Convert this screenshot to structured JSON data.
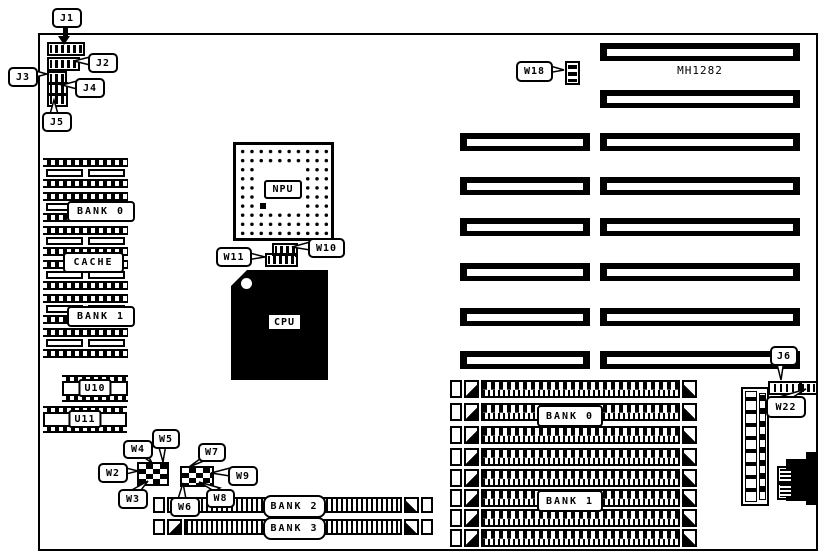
{
  "board": {
    "model": "MH1282"
  },
  "jumpers": {
    "j1": "J1",
    "j2": "J2",
    "j3": "J3",
    "j4": "J4",
    "j5": "J5",
    "j6": "J6",
    "w2": "W2",
    "w3": "W3",
    "w4": "W4",
    "w5": "W5",
    "w6": "W6",
    "w7": "W7",
    "w8": "W8",
    "w9": "W9",
    "w10": "W10",
    "w11": "W11",
    "w18": "W18",
    "w22": "W22"
  },
  "chips": {
    "npu": "NPU",
    "cpu": "CPU",
    "u10": "U10",
    "u11": "U11"
  },
  "memory": {
    "bank0_dip": "BANK 0",
    "cache": "CACHE",
    "bank1_dip": "BANK 1",
    "bank0_simm": "BANK 0",
    "bank1_simm": "BANK 1",
    "bank2_simm": "BANK 2",
    "bank3_simm": "BANK 3"
  },
  "colors": {
    "ink": "#000000",
    "paper": "#ffffff"
  }
}
